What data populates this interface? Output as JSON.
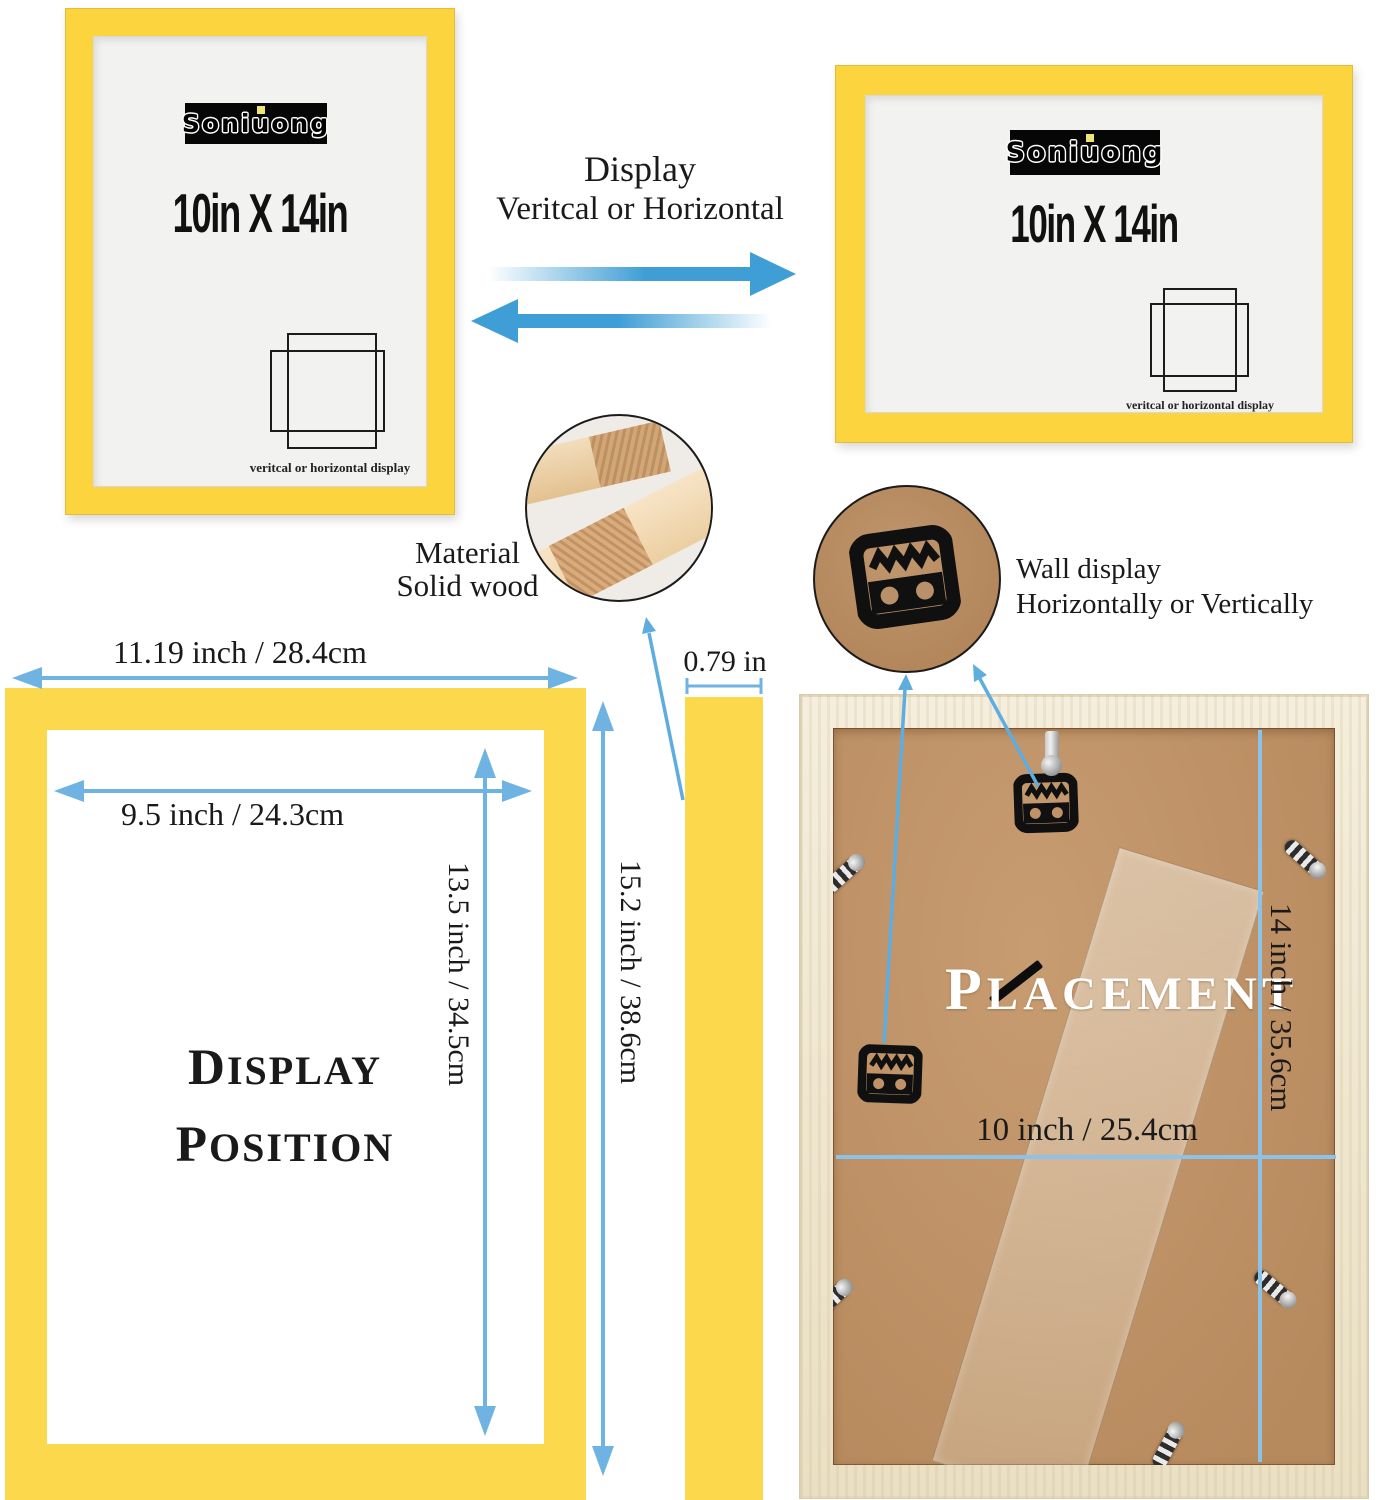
{
  "frames": {
    "vertical": {
      "logo": "Soniuong",
      "size": "10in X 14in",
      "caption": "veritcal or horizontal display"
    },
    "horizontal": {
      "logo": "Soniuong",
      "size": "10in X 14in",
      "caption": "veritcal or horizontal display"
    }
  },
  "orientation_note": {
    "line1": "Display",
    "line2": "Veritcal or Horizontal"
  },
  "material_callout": {
    "line1": "Material",
    "line2": "Solid wood"
  },
  "wall_callout": {
    "line1": "Wall display",
    "line2": "Horizontally or Vertically"
  },
  "front_diagram": {
    "outer_width": "11.19 inch / 28.4cm",
    "inner_width": "9.5 inch / 24.3cm",
    "inner_height": "13.5 inch / 34.5cm",
    "outer_height": "15.2 inch / 38.6cm",
    "position_line1": "DISPLAY",
    "position_line2": "POSITION"
  },
  "profile": {
    "thickness": "0.79 in"
  },
  "back_diagram": {
    "title": "PLACEMENT",
    "width": "10 inch / 25.4cm",
    "height": "14 inch / 35.6cm"
  },
  "colors": {
    "frame_yellow": "#fbd43e",
    "diagram_yellow": "#fcd94c",
    "big_arrow_blue": "#3f9ed5",
    "dimension_blue": "#6fb3e3",
    "panel_line_blue": "#8cc1e8",
    "pointer_blue": "#5fadde",
    "mdf_brown": "#bf9267",
    "wood_border": "#f0e6d1"
  }
}
